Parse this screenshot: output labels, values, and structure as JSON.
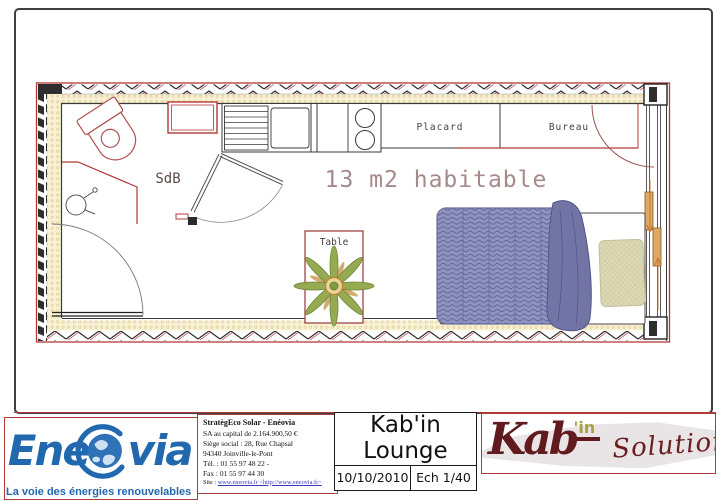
{
  "plan": {
    "area_label": "13 m2 habitable",
    "rooms": {
      "sdb": "SdB",
      "placard": "Placard",
      "bureau": "Bureau",
      "table": "Table"
    }
  },
  "footer": {
    "eneovia": {
      "logo_pre": "Ene",
      "logo_post": "via",
      "tagline": "La voie des énergies renouvelables"
    },
    "company": {
      "lines": [
        "StratègEco Solar - Enéovia",
        "SA au capital de 2.164.900,50 €",
        "Siège social : 28, Rue Chapsal",
        "94340 Joinville-le-Pont",
        "Tél. : 01 55 97 48 22 -",
        "Fax : 01 55 97 44 30"
      ],
      "site_label": "Site : ",
      "site_link": "www.eneovia.fr <http://www.eneovia.fr>"
    },
    "title_block": {
      "title_line1": "Kab'in",
      "title_line2": "Lounge",
      "date": "10/10/2010",
      "scale": "Ech 1/40"
    },
    "kabin_logo": {
      "word": "Kab",
      "sup": "'in",
      "solutions": "Solutions"
    }
  },
  "colors": {
    "plan_red": "#b03a36",
    "eneovia_blue": "#2268ae",
    "kabin_maroon": "#611a1d",
    "kabin_olive": "#a6a143"
  }
}
